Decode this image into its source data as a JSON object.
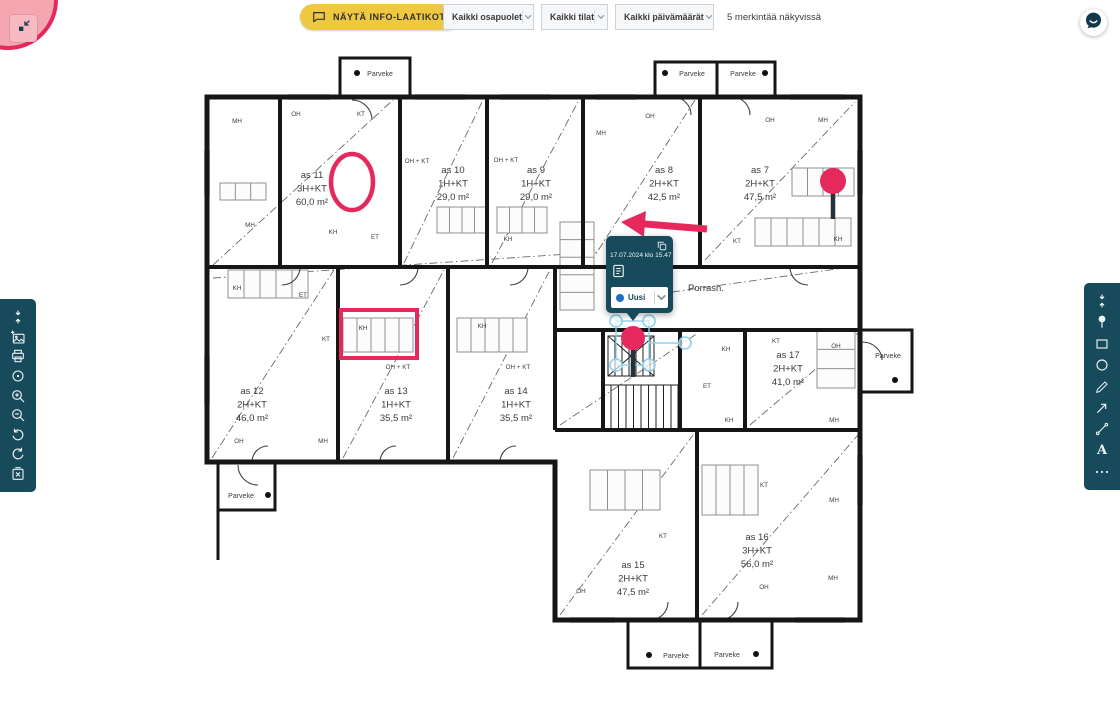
{
  "colors": {
    "accent_pink": "#e5295d",
    "pink_fill": "#f4a6b1",
    "teal": "#174a5b",
    "yellow": "#eec840",
    "handle_blue": "#8fd2ec",
    "status_blue": "#1d6fc0",
    "wall": "#161616"
  },
  "top_left_control": {
    "icon": "collapse-corner-icon"
  },
  "top_bar": {
    "show_info_button": {
      "label": "NÄYTÄ INFO-LAATIKOT",
      "icon": "speech-bubble-icon"
    },
    "filters": [
      {
        "id": "parties",
        "value": "Kaikki osapuolet"
      },
      {
        "id": "spaces",
        "value": "Kaikki tilat"
      },
      {
        "id": "dates",
        "value": "Kaikki päivämäärät"
      }
    ],
    "visible_count_text": "5 merkintää näkyvissä"
  },
  "left_toolbar": {
    "items": [
      {
        "name": "collapse-toolbar-icon"
      },
      {
        "name": "add-image-icon"
      },
      {
        "name": "print-icon"
      },
      {
        "name": "target-icon"
      },
      {
        "name": "zoom-in-icon"
      },
      {
        "name": "zoom-out-icon"
      },
      {
        "name": "undo-icon"
      },
      {
        "name": "redo-icon"
      },
      {
        "name": "delete-icon"
      }
    ]
  },
  "right_toolbar": {
    "items": [
      {
        "name": "collapse-toolbar-icon"
      },
      {
        "name": "pin-icon"
      },
      {
        "name": "rectangle-tool-icon"
      },
      {
        "name": "ellipse-tool-icon"
      },
      {
        "name": "pencil-icon"
      },
      {
        "name": "arrow-tool-icon"
      },
      {
        "name": "measure-icon"
      },
      {
        "name": "text-tool-icon"
      },
      {
        "name": "more-icon"
      }
    ]
  },
  "chat_button": {
    "icon": "chat-icon"
  },
  "annotation_popup": {
    "timestamp": "17.07.2024 klo 15.47",
    "status_dropdown": {
      "value": "Uusi",
      "dot_color": "#1d6fc0"
    }
  },
  "floor_plan": {
    "apartments": [
      {
        "name": "as 11",
        "type": "3H+KT",
        "area": "60,0 m²",
        "x": 312,
        "y": 178
      },
      {
        "name": "as 10",
        "type": "1H+KT",
        "area": "29,0 m²",
        "x": 453,
        "y": 173
      },
      {
        "name": "as 9",
        "type": "1H+KT",
        "area": "29,0 m²",
        "x": 536,
        "y": 173
      },
      {
        "name": "as 8",
        "type": "2H+KT",
        "area": "42,5 m²",
        "x": 664,
        "y": 173
      },
      {
        "name": "as 7",
        "type": "2H+KT",
        "area": "47,5 m²",
        "x": 760,
        "y": 173
      },
      {
        "name": "as 12",
        "type": "2H+KT",
        "area": "46,0 m²",
        "x": 252,
        "y": 394
      },
      {
        "name": "as 13",
        "type": "1H+KT",
        "area": "35,5 m²",
        "x": 396,
        "y": 394
      },
      {
        "name": "as 14",
        "type": "1H+KT",
        "area": "35,5 m²",
        "x": 516,
        "y": 394
      },
      {
        "name": "as 17",
        "type": "2H+KT",
        "area": "41,0 m²",
        "x": 788,
        "y": 358
      },
      {
        "name": "as 15",
        "type": "2H+KT",
        "area": "47,5 m²",
        "x": 633,
        "y": 568
      },
      {
        "name": "as 16",
        "type": "3H+KT",
        "area": "56,0 m²",
        "x": 757,
        "y": 540
      }
    ],
    "stairwell_label": {
      "text": "Porrash.",
      "x": 706,
      "y": 291
    },
    "balconies": [
      {
        "label": "Parveke",
        "x": 380,
        "y": 76,
        "dot_x": 357,
        "dot_y": 73
      },
      {
        "label": "Parveke",
        "x": 692,
        "y": 76,
        "dot_x": 665,
        "dot_y": 73
      },
      {
        "label": "Parveke",
        "x": 743,
        "y": 76,
        "dot_x": 765,
        "dot_y": 73
      },
      {
        "label": "Parveke",
        "x": 888,
        "y": 358,
        "dot_x": 895,
        "dot_y": 380
      },
      {
        "label": "Parveke",
        "x": 241,
        "y": 498,
        "dot_x": 268,
        "dot_y": 495
      },
      {
        "label": "Parveke",
        "x": 676,
        "y": 658,
        "dot_x": 649,
        "dot_y": 655
      },
      {
        "label": "Parveke",
        "x": 727,
        "y": 657,
        "dot_x": 756,
        "dot_y": 654
      }
    ],
    "room_labels": [
      {
        "t": "MH",
        "x": 237,
        "y": 123
      },
      {
        "t": "OH",
        "x": 296,
        "y": 116
      },
      {
        "t": "KT",
        "x": 361,
        "y": 116
      },
      {
        "t": "OH + KT",
        "x": 417,
        "y": 163
      },
      {
        "t": "OH + KT",
        "x": 506,
        "y": 162
      },
      {
        "t": "MH",
        "x": 601,
        "y": 135
      },
      {
        "t": "OH",
        "x": 650,
        "y": 118
      },
      {
        "t": "OH",
        "x": 770,
        "y": 122
      },
      {
        "t": "MH",
        "x": 823,
        "y": 122
      },
      {
        "t": "MH",
        "x": 250,
        "y": 227
      },
      {
        "t": "KH",
        "x": 333,
        "y": 234
      },
      {
        "t": "ET",
        "x": 375,
        "y": 239
      },
      {
        "t": "KH",
        "x": 508,
        "y": 241
      },
      {
        "t": "KT",
        "x": 737,
        "y": 243
      },
      {
        "t": "KH",
        "x": 838,
        "y": 241
      },
      {
        "t": "KH",
        "x": 237,
        "y": 290
      },
      {
        "t": "ET",
        "x": 303,
        "y": 297
      },
      {
        "t": "KT",
        "x": 326,
        "y": 341
      },
      {
        "t": "KH",
        "x": 363,
        "y": 330
      },
      {
        "t": "KH",
        "x": 482,
        "y": 328
      },
      {
        "t": "OH + KT",
        "x": 398,
        "y": 369
      },
      {
        "t": "OH + KT",
        "x": 518,
        "y": 369
      },
      {
        "t": "OH",
        "x": 239,
        "y": 443
      },
      {
        "t": "MH",
        "x": 323,
        "y": 443
      },
      {
        "t": "KH",
        "x": 726,
        "y": 351
      },
      {
        "t": "KT",
        "x": 776,
        "y": 343
      },
      {
        "t": "OH",
        "x": 836,
        "y": 348
      },
      {
        "t": "ET",
        "x": 707,
        "y": 388
      },
      {
        "t": "KH",
        "x": 729,
        "y": 422
      },
      {
        "t": "MH",
        "x": 834,
        "y": 422
      },
      {
        "t": "KT",
        "x": 764,
        "y": 487
      },
      {
        "t": "MH",
        "x": 834,
        "y": 502
      },
      {
        "t": "KT",
        "x": 663,
        "y": 538
      },
      {
        "t": "OH",
        "x": 581,
        "y": 593
      },
      {
        "t": "OH",
        "x": 764,
        "y": 589
      },
      {
        "t": "MH",
        "x": 833,
        "y": 580
      }
    ]
  },
  "annotations": {
    "ellipse": {
      "cx": 352,
      "cy": 182,
      "rx": 21,
      "ry": 28
    },
    "pin_as7": {
      "cx": 833,
      "cy": 181,
      "r": 13,
      "stem": 28
    },
    "arrow": {
      "tip_x": 621,
      "tip_y": 222,
      "tail_x": 707,
      "tail_y": 229
    },
    "rectangle": {
      "x": 341,
      "y": 310,
      "w": 76,
      "h": 48
    },
    "selected_pin": {
      "cx": 633,
      "cy": 338,
      "r": 12,
      "stem": 30
    }
  }
}
